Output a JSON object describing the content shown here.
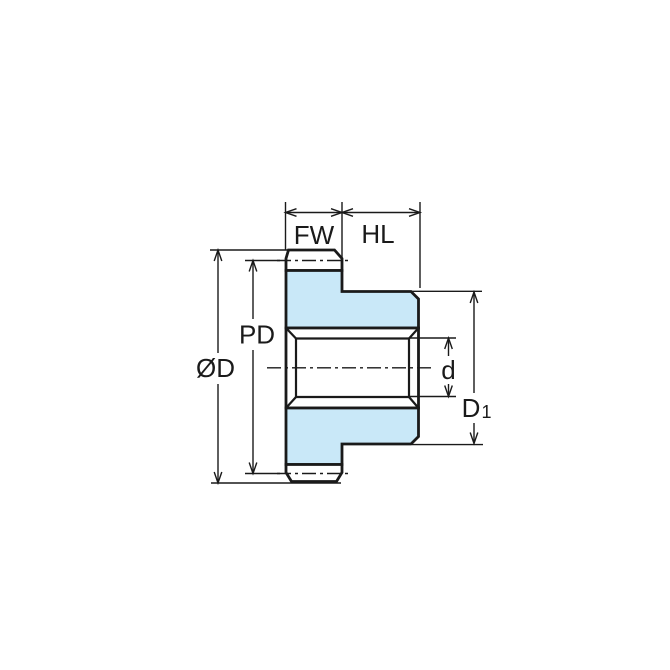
{
  "drawing": {
    "labels": {
      "face_width": "FW",
      "hub_length": "HL",
      "pitch_diameter": "PD",
      "outside_diameter": "ØD",
      "bore_diameter": "d",
      "hub_diameter_base": "D",
      "hub_diameter_subscript": "1"
    },
    "colors": {
      "part_fill": "#c9e8f8",
      "line": "#1a1a1a",
      "background": "#ffffff"
    }
  }
}
